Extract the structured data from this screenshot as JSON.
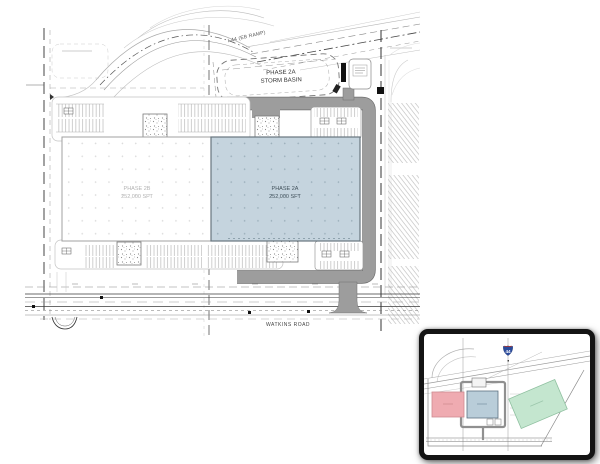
{
  "plan": {
    "highway_label": "I-44 (EB RAMP)",
    "storm_basin": {
      "line1": "PHASE 2A",
      "line2": "STORM BASIN"
    },
    "buildings": [
      {
        "name": "PHASE 2B",
        "area": "252,000 SFT"
      },
      {
        "name": "PHASE 2A",
        "area": "252,000 SFT"
      }
    ],
    "road_label": "WATKINS ROAD"
  },
  "inset": {
    "interstate_shield": "44"
  },
  "colors": {
    "phase2a_fill": "#c5d4de",
    "phase2b_fill": "#ffffff",
    "road_gray": "#9d9d9d",
    "road_edge": "#6f6f6f",
    "inset_pink": "#efabb1",
    "inset_blue": "#b9cdd9",
    "inset_green": "#c4e6cf",
    "shield_blue": "#2b4b9c"
  }
}
